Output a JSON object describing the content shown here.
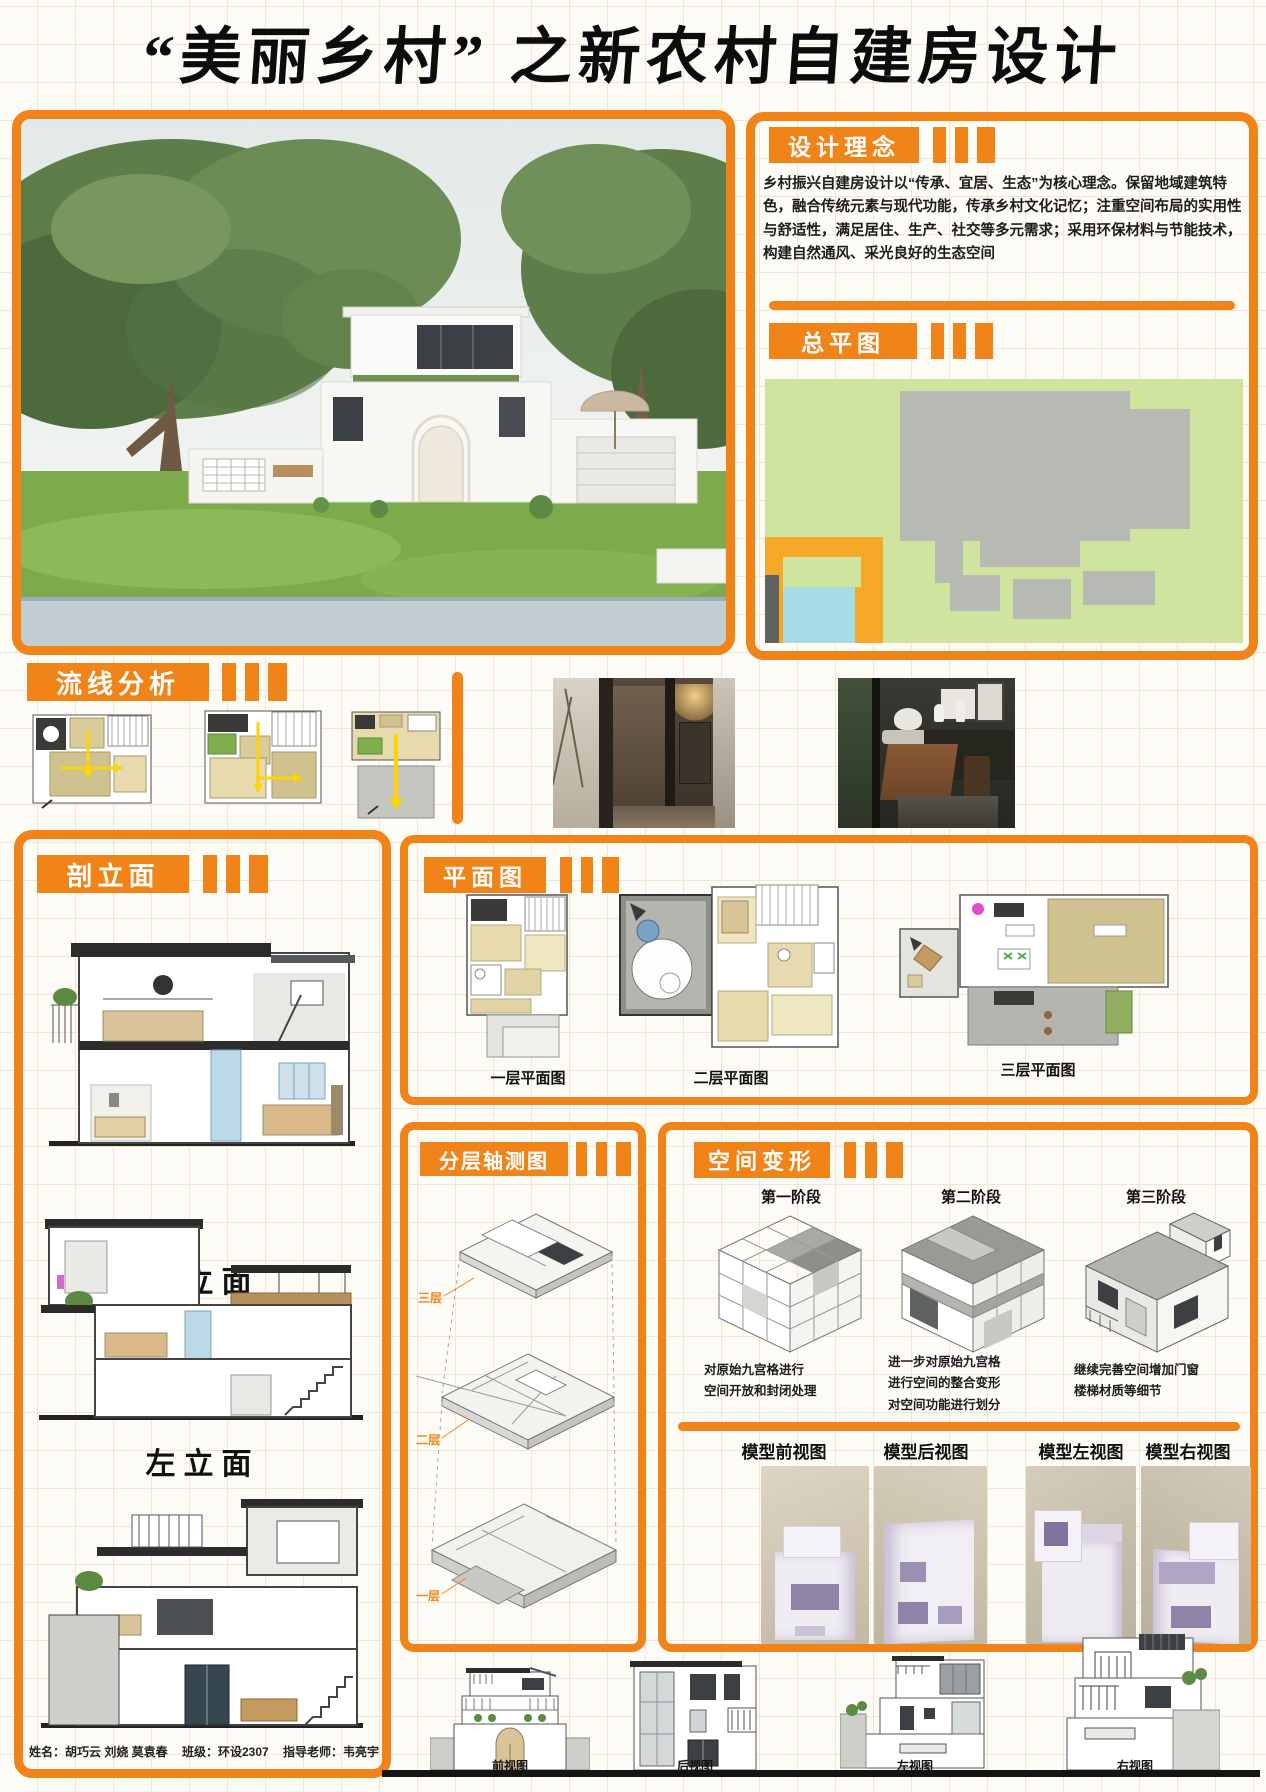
{
  "accent": "#f08418",
  "page": {
    "title": "“美丽乡村” 之新农村自建房设计"
  },
  "design_concept": {
    "heading": "设计理念",
    "body": "乡村振兴自建房设计以“传承、宜居、生态”为核心理念。保留地域建筑特色，融合传统元素与现代功能，传承乡村文化记忆；注重空间布局的实用性与舒适性，满足居住、生产、社交等多元需求；采用环保材料与节能技术，构建自然通风、采光良好的生态空间"
  },
  "site_plan": {
    "heading": "总平图"
  },
  "circulation": {
    "heading": "流线分析"
  },
  "section_elevation": {
    "heading": "剖立面",
    "labels": [
      "正立面",
      "左立面"
    ]
  },
  "floor_plans": {
    "heading": "平面图",
    "labels": [
      "一层平面图",
      "二层平面图",
      "三层平面图"
    ]
  },
  "axon": {
    "heading": "分层轴测图",
    "floor_tags": [
      "三层",
      "二层",
      "一层"
    ]
  },
  "transform": {
    "heading": "空间变形",
    "stages": [
      {
        "label": "第一阶段",
        "desc": "对原始九宫格进行\n空间开放和封闭处理"
      },
      {
        "label": "第二阶段",
        "desc": "进一步对原始九宫格\n进行空间的整合变形\n对空间功能进行划分"
      },
      {
        "label": "第三阶段",
        "desc": "继续完善空间增加门窗\n楼梯材质等细节"
      }
    ],
    "model_views": [
      "模型前视图",
      "模型后视图",
      "模型左视图",
      "模型右视图"
    ]
  },
  "bottom_views": [
    "前视图",
    "后视图",
    "左视图",
    "右视图"
  ],
  "credits": {
    "name_label": "姓名：",
    "names": "胡巧云 刘娆 莫袁春",
    "class_label": "班级：",
    "class_value": "环设2307",
    "teacher_label": "指导老师：",
    "teacher": "韦亮宇"
  }
}
